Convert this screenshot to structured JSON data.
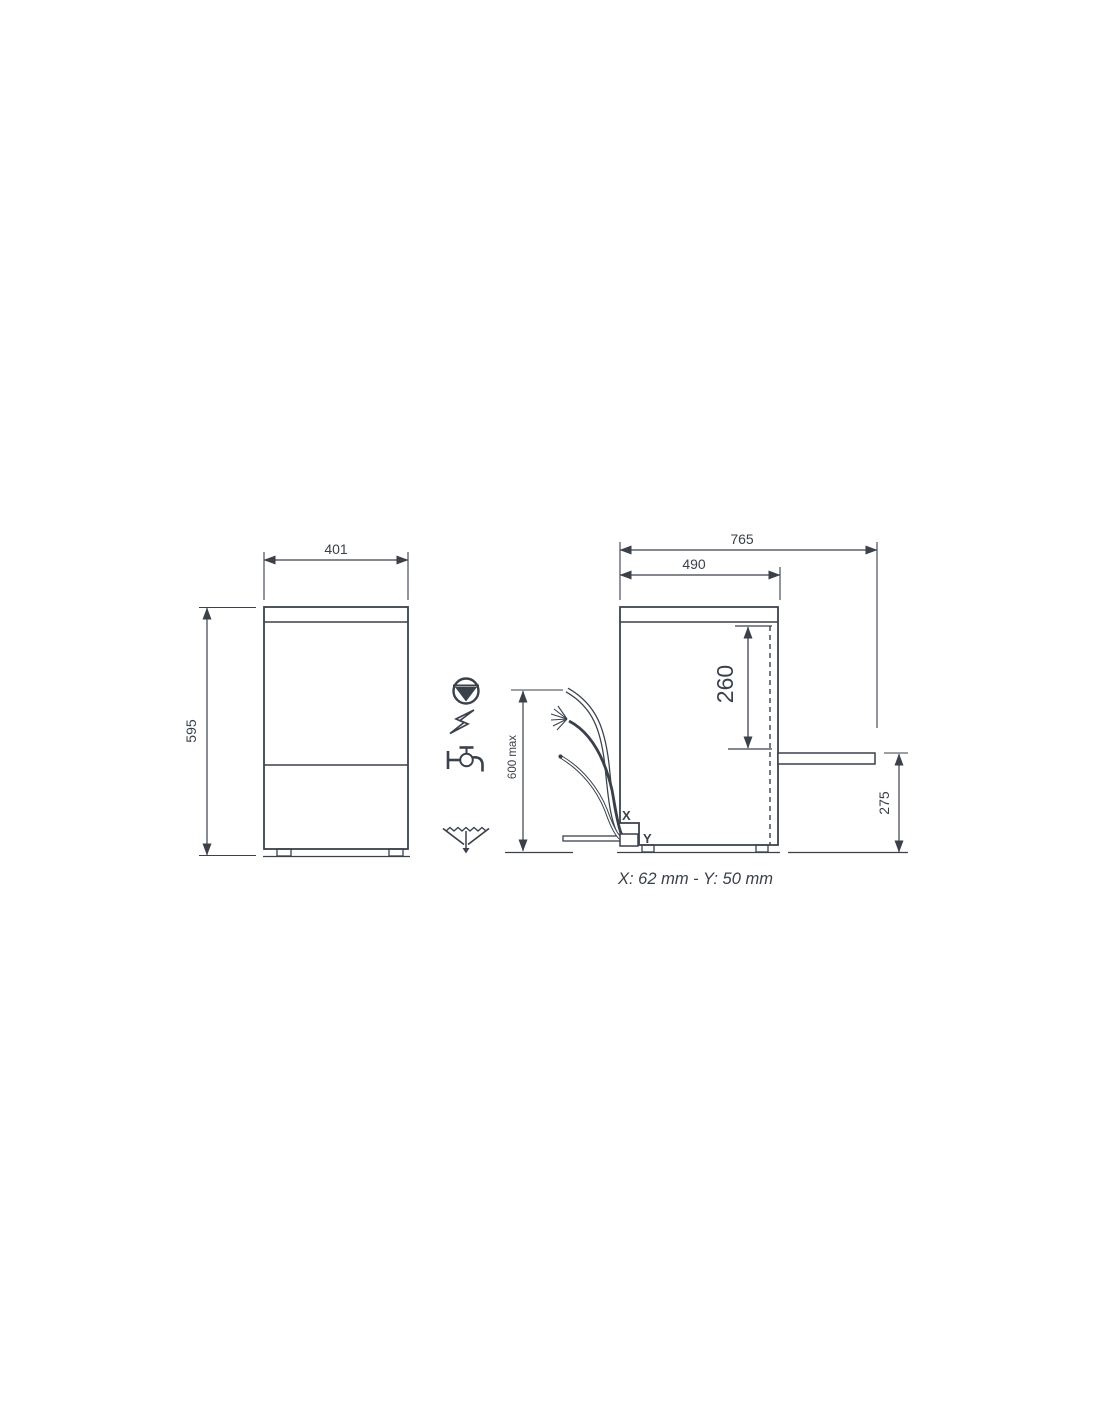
{
  "drawing": {
    "title": "appliance-installation-dimension-drawing",
    "colors": {
      "line": "#3a414b",
      "text": "#3a414b",
      "background": "#ffffff"
    },
    "front_view": {
      "width_mm": "401",
      "height_mm": "595"
    },
    "side_view": {
      "total_depth_mm": "765",
      "body_depth_mm": "490",
      "drain_height_mm": "260",
      "outlet_height_mm": "275",
      "hose_length_max": "600 max",
      "connection_x": "X",
      "connection_y": "Y"
    },
    "icons": {
      "pump": "pump-icon",
      "electric": "electric-bolt-icon",
      "water_inlet": "water-tap-icon",
      "drain": "drain-icon"
    },
    "footnote": "X: 62 mm - Y: 50 mm"
  }
}
